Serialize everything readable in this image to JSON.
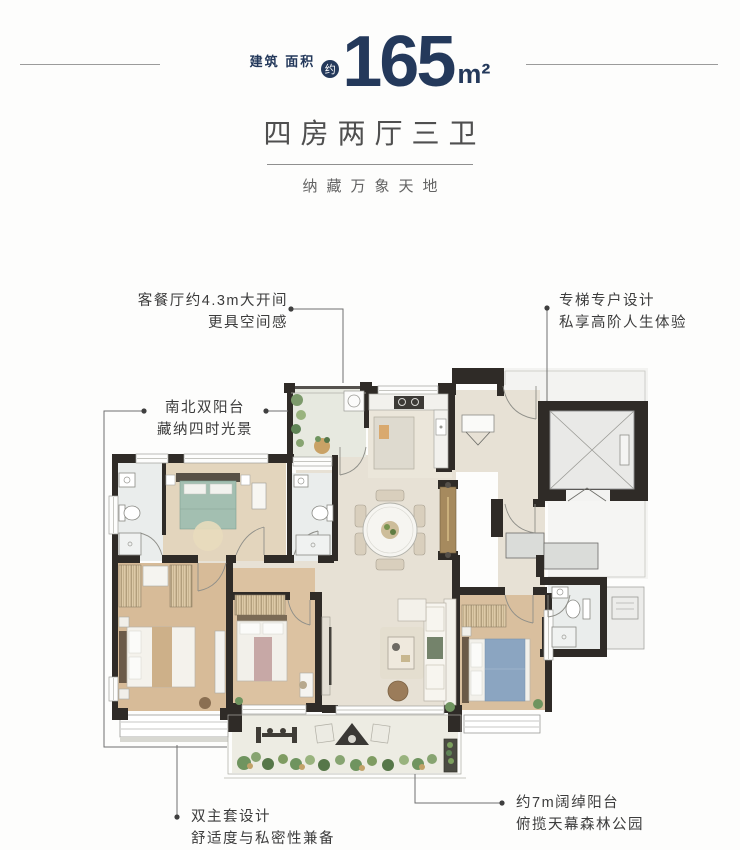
{
  "header": {
    "area_label_line1": "建筑",
    "area_label_line2": "面积",
    "approx_label": "约",
    "area_value": "165",
    "area_unit": "m²"
  },
  "title": "四房两厅三卫",
  "subtitle": "纳藏万象天地",
  "annotations": {
    "living_dining": {
      "line1": "客餐厅约4.3m大开间",
      "line2": "更具空间感"
    },
    "elevator": {
      "line1": "专梯专户设计",
      "line2": "私享高阶人生体验"
    },
    "dual_balcony": {
      "line1": "南北双阳台",
      "line2": "藏纳四时光景"
    },
    "dual_master": {
      "line1": "双主套设计",
      "line2": "舒适度与私密性兼备"
    },
    "south_balcony": {
      "line1": "约7m阔绰阳台",
      "line2": "俯揽天幕森林公园"
    }
  },
  "colors": {
    "accent_navy": "#24395B",
    "heading_gray": "#4F4F4F",
    "annotation_gray": "#3C3C3C",
    "wall_dark": "#2F2B27"
  }
}
